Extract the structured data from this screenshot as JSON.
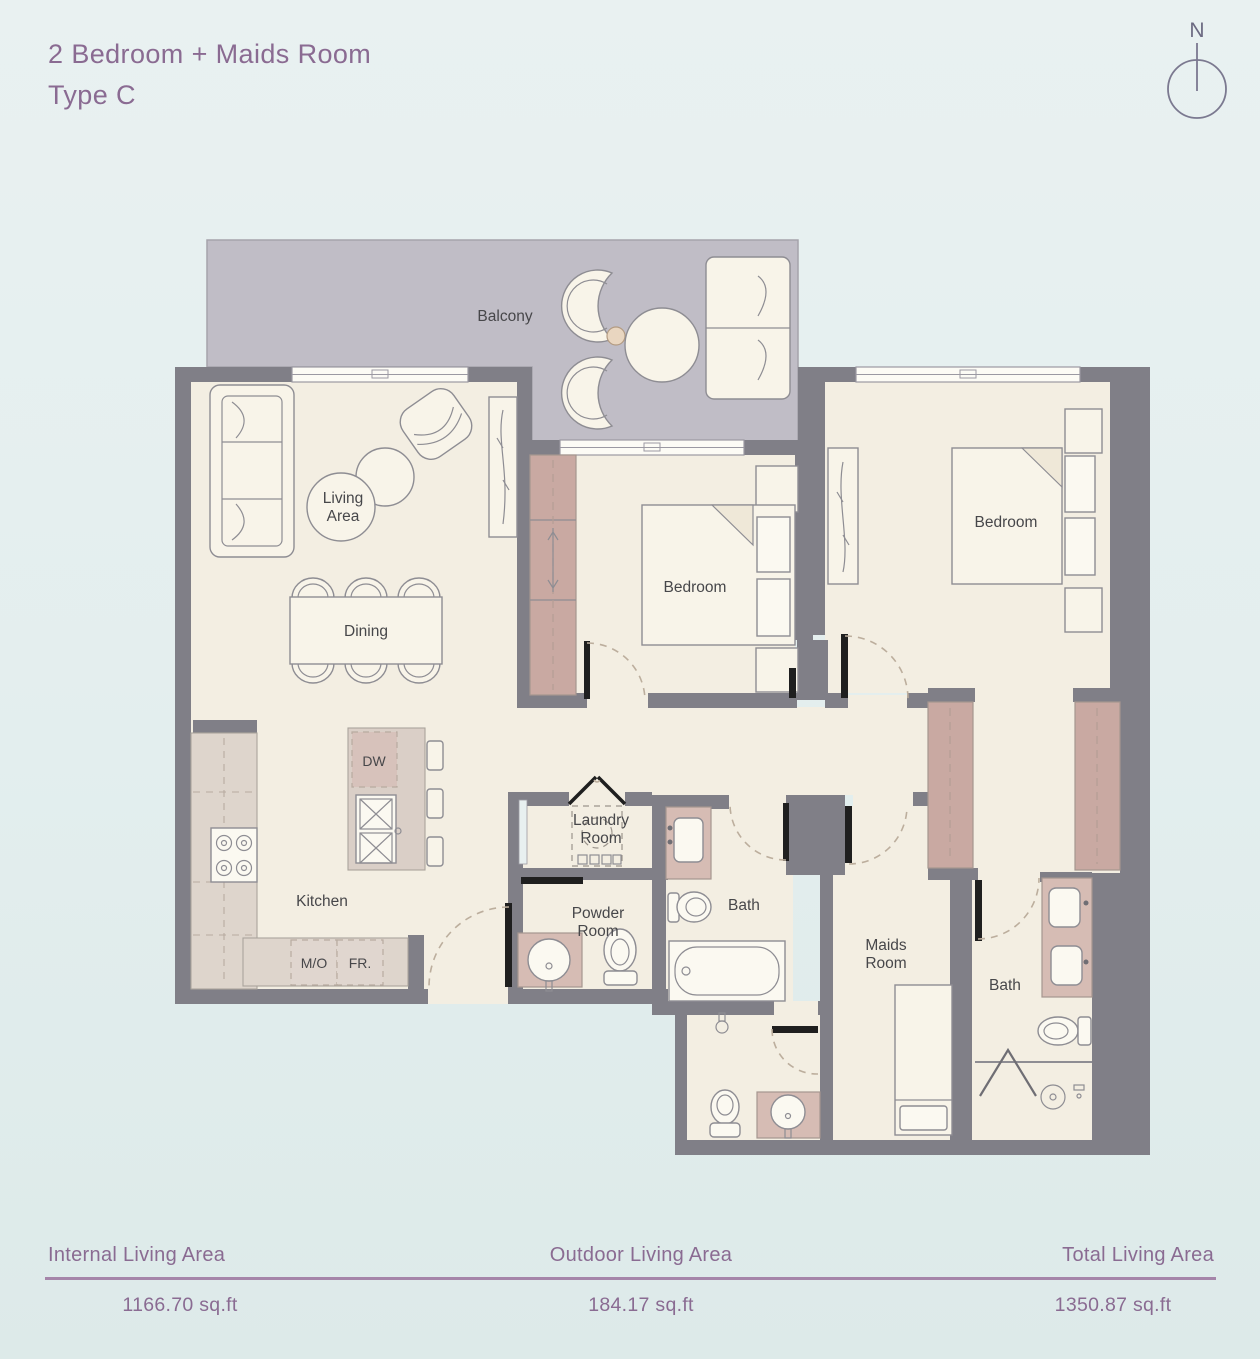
{
  "header": {
    "title": "2 Bedroom + Maids Room",
    "subtitle": "Type C"
  },
  "compass": {
    "label": "N"
  },
  "plan": {
    "labels": {
      "balcony": "Balcony",
      "living_1": "Living",
      "living_2": "Area",
      "dining": "Dining",
      "kitchen": "Kitchen",
      "bedroom_1": "Bedroom",
      "bedroom_2": "Bedroom",
      "laundry_1": "Laundry",
      "laundry_2": "Room",
      "powder_1": "Powder",
      "powder_2": "Room",
      "bath_1": "Bath",
      "bath_2": "Bath",
      "maids_1": "Maids",
      "maids_2": "Room",
      "dw": "DW",
      "mo": "M/O",
      "fr": "FR."
    },
    "colors": {
      "accent": "#8a6b92",
      "wall": "#807f87",
      "floor": "#f3eee2",
      "balcony": "#c0bdc6",
      "closet": "#c9a9a2",
      "counter": "#ded5cc",
      "vanity": "#d6bcb4"
    }
  },
  "stats": {
    "items": [
      {
        "label": "Internal Living Area",
        "value": "1166.70 sq.ft"
      },
      {
        "label": "Outdoor Living Area",
        "value": "184.17 sq.ft"
      },
      {
        "label": "Total Living Area",
        "value": "1350.87 sq.ft"
      }
    ]
  }
}
